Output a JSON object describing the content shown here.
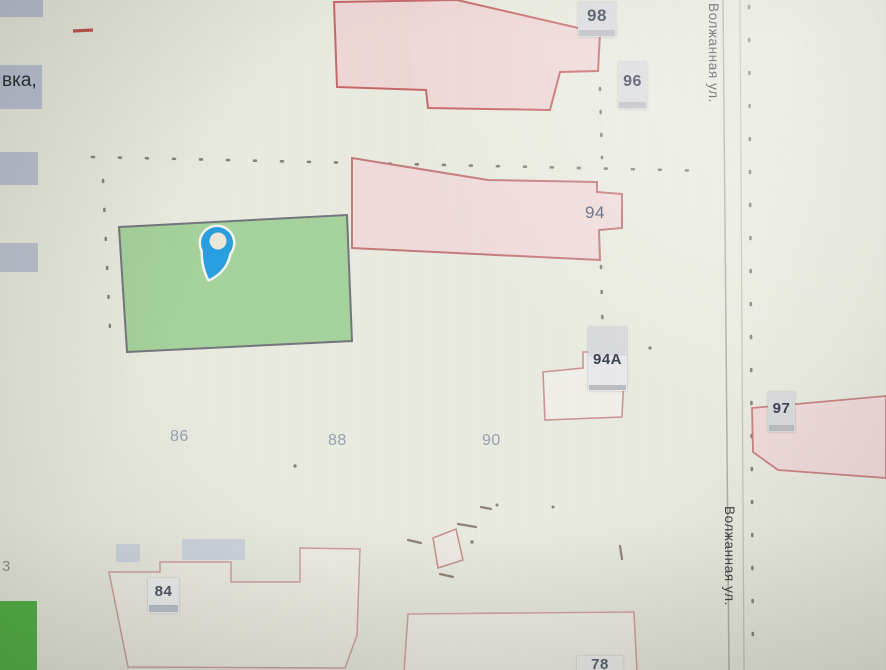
{
  "street": {
    "top_label": "Волжанная ул.",
    "bottom_label": "Волжанная ул."
  },
  "badges": {
    "n98": "98",
    "n96": "96",
    "n94a": "94А",
    "n97": "97",
    "n84": "84",
    "n78": "78"
  },
  "house_labels": {
    "n94": "94",
    "n86": "86",
    "n88": "88",
    "n90": "90"
  },
  "sidebar": {
    "item_partial_text": "вка,",
    "count_partial": "3"
  },
  "colors": {
    "pin_blue": "#2a9fe0",
    "parcel_green": "#a5d29d",
    "building_pink_fill": "#f0d9d7",
    "building_pink_outline": "#c47b7b",
    "badge_bg": "#dadbde",
    "badge_strip": "#bcbdc3",
    "green_button": "#4db242",
    "map_background": "#e9ebe0"
  }
}
